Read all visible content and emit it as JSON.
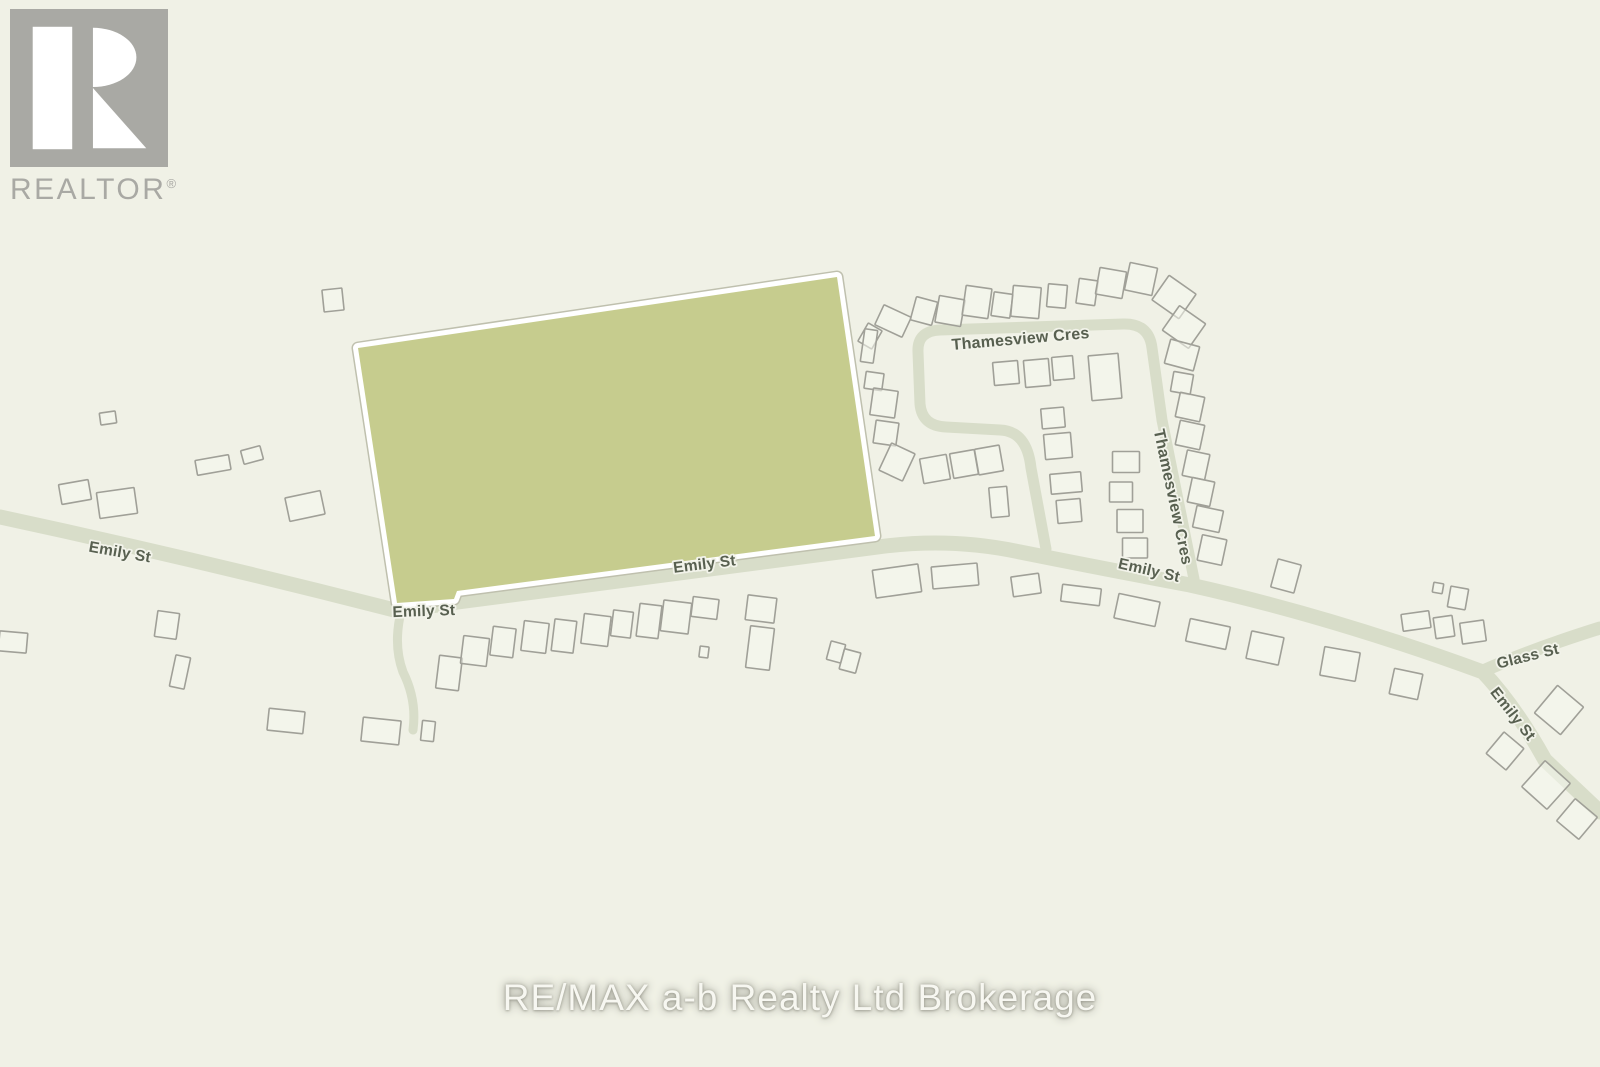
{
  "branding": {
    "realtor_logo": {
      "text": "REALTOR",
      "registered_mark": "®"
    },
    "watermark": "RE/MAX a-b Realty Ltd Brokerage"
  },
  "map": {
    "colors": {
      "background": "#f0f1e6",
      "road": "#d8ddc9",
      "parcel_fill": "#c6cc8e",
      "parcel_border": "#ffffff",
      "parcel_hairline": "#bfc0ae",
      "building_stroke": "#a0a098",
      "building_fill": "#f6f7ee",
      "label_color": "#586050",
      "label_halo": "#f2f3ea",
      "logo_gray": "#a9a9a4"
    },
    "parcel": {
      "points": "358,348 837,277 875,536 457,591 454,599 397,603"
    },
    "roads": [
      {
        "name": "Emily St",
        "d": "M 0,517 Q 200,560 398,611 L 458,602 L 878,547 Q 950,537 1020,552 Q 1100,568 1190,585 Q 1330,616 1483,672 Q 1515,706 1545,760 L 1600,812",
        "w": 15
      },
      {
        "name": "Glass St",
        "d": "M 1483,671 Q 1530,650 1600,628",
        "w": 13
      },
      {
        "name": "Emily St spur",
        "d": "M 401,612 Q 393,645 403,672 Q 417,700 413,730",
        "w": 9
      },
      {
        "name": "Thamesview Cres",
        "d": "M 1046,549 L 1031,468 Q 1027,431 1000,430 L 946,427 Q 922,426 920,404 L 918,352 Q 917,331 940,330 L 1123,324 Q 1149,323 1152,348 L 1162,420 Q 1180,510 1194,579",
        "w": 11
      }
    ],
    "street_labels": [
      {
        "text": "Emily St",
        "x": 119,
        "y": 557,
        "r": 10,
        "s": 15.5
      },
      {
        "text": "Emily St",
        "x": 424,
        "y": 616,
        "r": -2,
        "s": 15.5
      },
      {
        "text": "Emily St",
        "x": 705,
        "y": 569,
        "r": -7,
        "s": 15.5
      },
      {
        "text": "Emily St",
        "x": 1148,
        "y": 575,
        "r": 13,
        "s": 15.5
      },
      {
        "text": "Glass St",
        "x": 1529,
        "y": 661,
        "r": -14,
        "s": 15.5
      },
      {
        "text": "Emily St",
        "x": 1509,
        "y": 717,
        "r": 52,
        "s": 15.5
      },
      {
        "text": "Thamesview Cres",
        "x": 1021,
        "y": 344,
        "r": -5,
        "s": 16
      },
      {
        "text": "Thamesview Cres",
        "x": 1168,
        "y": 498,
        "r": 78,
        "s": 16
      }
    ],
    "buildings": [
      [
        108,
        418,
        16,
        12,
        -8
      ],
      [
        333,
        300,
        20,
        22,
        -6
      ],
      [
        213,
        465,
        34,
        15,
        -10
      ],
      [
        252,
        455,
        20,
        14,
        -15
      ],
      [
        75,
        492,
        30,
        20,
        -10
      ],
      [
        117,
        503,
        38,
        26,
        -8
      ],
      [
        305,
        506,
        36,
        24,
        -12
      ],
      [
        13,
        642,
        28,
        20,
        5
      ],
      [
        167,
        625,
        22,
        26,
        8
      ],
      [
        180,
        672,
        15,
        32,
        12
      ],
      [
        286,
        721,
        36,
        22,
        6
      ],
      [
        381,
        731,
        38,
        24,
        6
      ],
      [
        428,
        731,
        13,
        20,
        6
      ],
      [
        449,
        673,
        23,
        33,
        7
      ],
      [
        475,
        651,
        26,
        28,
        7
      ],
      [
        503,
        642,
        23,
        29,
        7
      ],
      [
        535,
        637,
        25,
        30,
        7
      ],
      [
        564,
        636,
        22,
        32,
        7
      ],
      [
        596,
        630,
        27,
        30,
        7
      ],
      [
        622,
        624,
        20,
        26,
        7
      ],
      [
        649,
        621,
        22,
        33,
        7
      ],
      [
        676,
        617,
        28,
        31,
        7
      ],
      [
        705,
        608,
        26,
        20,
        7
      ],
      [
        704,
        652,
        9,
        11,
        7
      ],
      [
        761,
        609,
        29,
        25,
        7
      ],
      [
        760,
        648,
        24,
        42,
        7
      ],
      [
        836,
        652,
        15,
        19,
        15
      ],
      [
        850,
        661,
        17,
        21,
        15
      ],
      [
        897,
        581,
        46,
        28,
        -8
      ],
      [
        955,
        576,
        46,
        22,
        -5
      ],
      [
        1026,
        585,
        28,
        20,
        -8
      ],
      [
        1081,
        595,
        39,
        17,
        7
      ],
      [
        1137,
        610,
        42,
        25,
        12
      ],
      [
        1208,
        634,
        41,
        23,
        12
      ],
      [
        1265,
        648,
        33,
        28,
        12
      ],
      [
        1340,
        664,
        36,
        29,
        10
      ],
      [
        1406,
        684,
        29,
        26,
        12
      ],
      [
        1286,
        576,
        24,
        29,
        15
      ],
      [
        1438,
        588,
        10,
        10,
        10
      ],
      [
        1458,
        598,
        18,
        21,
        10
      ],
      [
        1416,
        621,
        28,
        17,
        -8
      ],
      [
        1444,
        627,
        19,
        21,
        -8
      ],
      [
        1473,
        632,
        24,
        21,
        -8
      ],
      [
        1559,
        710,
        34,
        36,
        40
      ],
      [
        1505,
        751,
        26,
        28,
        40
      ],
      [
        1546,
        785,
        34,
        35,
        42
      ],
      [
        1577,
        819,
        29,
        29,
        40
      ],
      [
        870,
        336,
        16,
        21,
        30
      ],
      [
        893,
        321,
        30,
        22,
        25
      ],
      [
        924,
        311,
        22,
        24,
        15
      ],
      [
        950,
        311,
        26,
        27,
        10
      ],
      [
        977,
        302,
        26,
        30,
        8
      ],
      [
        1002,
        305,
        19,
        24,
        8
      ],
      [
        1026,
        302,
        28,
        31,
        5
      ],
      [
        1057,
        296,
        19,
        23,
        5
      ],
      [
        1087,
        292,
        19,
        25,
        8
      ],
      [
        1111,
        283,
        27,
        27,
        10
      ],
      [
        1141,
        279,
        28,
        28,
        12
      ],
      [
        1174,
        297,
        33,
        30,
        35
      ],
      [
        1184,
        327,
        32,
        30,
        35
      ],
      [
        869,
        346,
        13,
        33,
        8
      ],
      [
        874,
        381,
        18,
        17,
        8
      ],
      [
        884,
        403,
        25,
        27,
        8
      ],
      [
        886,
        433,
        23,
        23,
        8
      ],
      [
        897,
        462,
        26,
        30,
        25
      ],
      [
        1006,
        373,
        25,
        23,
        -5
      ],
      [
        1037,
        373,
        25,
        27,
        -5
      ],
      [
        1063,
        368,
        21,
        23,
        -5
      ],
      [
        1105,
        377,
        30,
        45,
        -5
      ],
      [
        935,
        469,
        27,
        25,
        -10
      ],
      [
        964,
        464,
        25,
        25,
        -10
      ],
      [
        989,
        460,
        25,
        26,
        -10
      ],
      [
        999,
        502,
        18,
        30,
        -5
      ],
      [
        1053,
        418,
        23,
        20,
        -5
      ],
      [
        1058,
        446,
        27,
        25,
        -5
      ],
      [
        1066,
        483,
        31,
        20,
        -5
      ],
      [
        1069,
        511,
        24,
        23,
        -5
      ],
      [
        1126,
        462,
        27,
        21,
        0
      ],
      [
        1121,
        492,
        23,
        20,
        0
      ],
      [
        1130,
        521,
        26,
        23,
        0
      ],
      [
        1135,
        548,
        25,
        20,
        0
      ],
      [
        1182,
        355,
        30,
        25,
        15
      ],
      [
        1182,
        383,
        20,
        20,
        10
      ],
      [
        1190,
        407,
        25,
        25,
        12
      ],
      [
        1190,
        435,
        25,
        25,
        12
      ],
      [
        1196,
        465,
        23,
        26,
        12
      ],
      [
        1201,
        492,
        23,
        25,
        12
      ],
      [
        1208,
        519,
        27,
        22,
        12
      ],
      [
        1212,
        550,
        25,
        26,
        12
      ]
    ]
  }
}
